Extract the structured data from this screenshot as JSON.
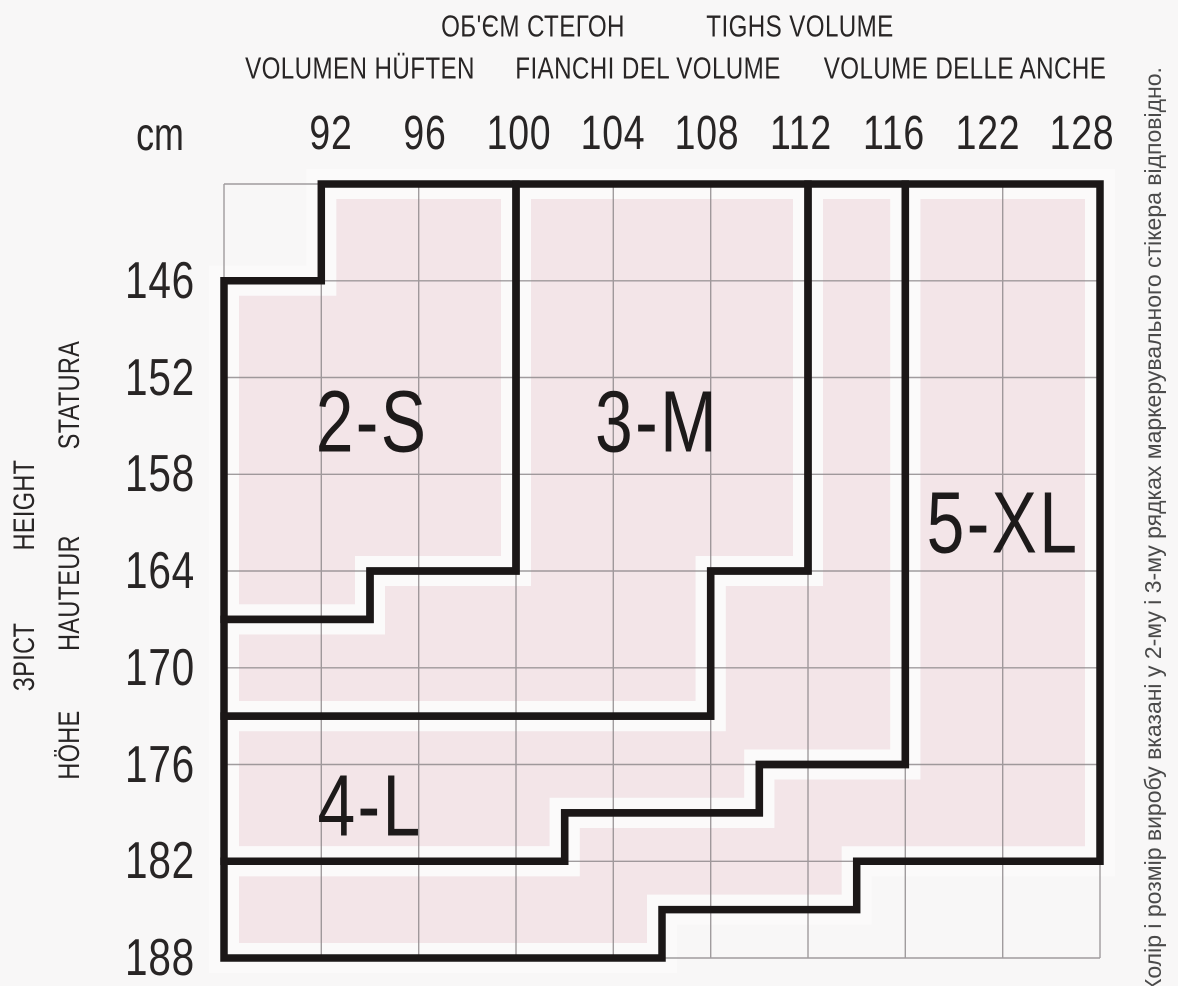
{
  "header": {
    "line1": [
      {
        "text": "ОБ'ЄМ СТЕГОН",
        "x": 533
      },
      {
        "text": "TIGHS VOLUME",
        "x": 800
      }
    ],
    "line2": [
      {
        "text": "VOLUMEN HÜFTEN",
        "x": 360
      },
      {
        "text": "FIANCHI DEL VOLUME",
        "x": 648
      },
      {
        "text": "VOLUME DELLE ANCHE",
        "x": 965
      }
    ],
    "unit_label": "cm"
  },
  "hip_values": [
    "92",
    "96",
    "100",
    "104",
    "108",
    "112",
    "116",
    "122",
    "128"
  ],
  "height_values": [
    "146",
    "152",
    "158",
    "164",
    "170",
    "176",
    "182",
    "188"
  ],
  "left_axis_words": [
    {
      "text": "STATURA",
      "x": 70,
      "y": 395
    },
    {
      "text": "HEIGHT",
      "x": 25,
      "y": 505
    },
    {
      "text": "HAUTEUR",
      "x": 70,
      "y": 593
    },
    {
      "text": "ЗРІСТ",
      "x": 25,
      "y": 657
    },
    {
      "text": "HÖHE",
      "x": 70,
      "y": 745
    }
  ],
  "side_note": "Колір і розмір виробу вказані у 2-му і 3-му рядках маркерувального стікера відповідно.",
  "zones": [
    {
      "label": "2-S",
      "label_pos": [
        1.52,
        2.46
      ],
      "points": [
        [
          1,
          0
        ],
        [
          3,
          0
        ],
        [
          3,
          4
        ],
        [
          1.5,
          4
        ],
        [
          1.5,
          4.5
        ],
        [
          0,
          4.5
        ],
        [
          0,
          1
        ],
        [
          1,
          1
        ]
      ]
    },
    {
      "label": "3-M",
      "label_pos": [
        4.45,
        2.46
      ],
      "points": [
        [
          3,
          0
        ],
        [
          6,
          0
        ],
        [
          6,
          4
        ],
        [
          5,
          4
        ],
        [
          5,
          5.5
        ],
        [
          0,
          5.5
        ],
        [
          0,
          4.5
        ],
        [
          1.5,
          4.5
        ],
        [
          1.5,
          4
        ],
        [
          3,
          4
        ]
      ]
    },
    {
      "label": "4-L",
      "label_pos": [
        1.5,
        6.43
      ],
      "points": [
        [
          6,
          0
        ],
        [
          7,
          0
        ],
        [
          7,
          6
        ],
        [
          5.5,
          6
        ],
        [
          5.5,
          6.5
        ],
        [
          3.5,
          6.5
        ],
        [
          3.5,
          7
        ],
        [
          0,
          7
        ],
        [
          0,
          5.5
        ],
        [
          5,
          5.5
        ],
        [
          5,
          4
        ],
        [
          6,
          4
        ]
      ]
    },
    {
      "label": "5-XL",
      "label_pos": [
        8.0,
        3.5
      ],
      "points": [
        [
          7,
          0
        ],
        [
          9,
          0
        ],
        [
          9,
          7
        ],
        [
          6.5,
          7
        ],
        [
          6.5,
          7.5
        ],
        [
          4.5,
          7.5
        ],
        [
          4.5,
          8
        ],
        [
          0,
          8
        ],
        [
          0,
          7
        ],
        [
          3.5,
          7
        ],
        [
          3.5,
          6.5
        ],
        [
          5.5,
          6.5
        ],
        [
          5.5,
          6
        ],
        [
          7,
          6
        ]
      ]
    }
  ],
  "colors": {
    "background": "#f8f7f7",
    "zone_fill": "#f3e5e8",
    "zone_inner_margin": "#fbfafa",
    "zone_border": "#1b1717",
    "grid_line": "#8a8587",
    "label_text": "#282525",
    "note_text": "#4a4a4a"
  }
}
